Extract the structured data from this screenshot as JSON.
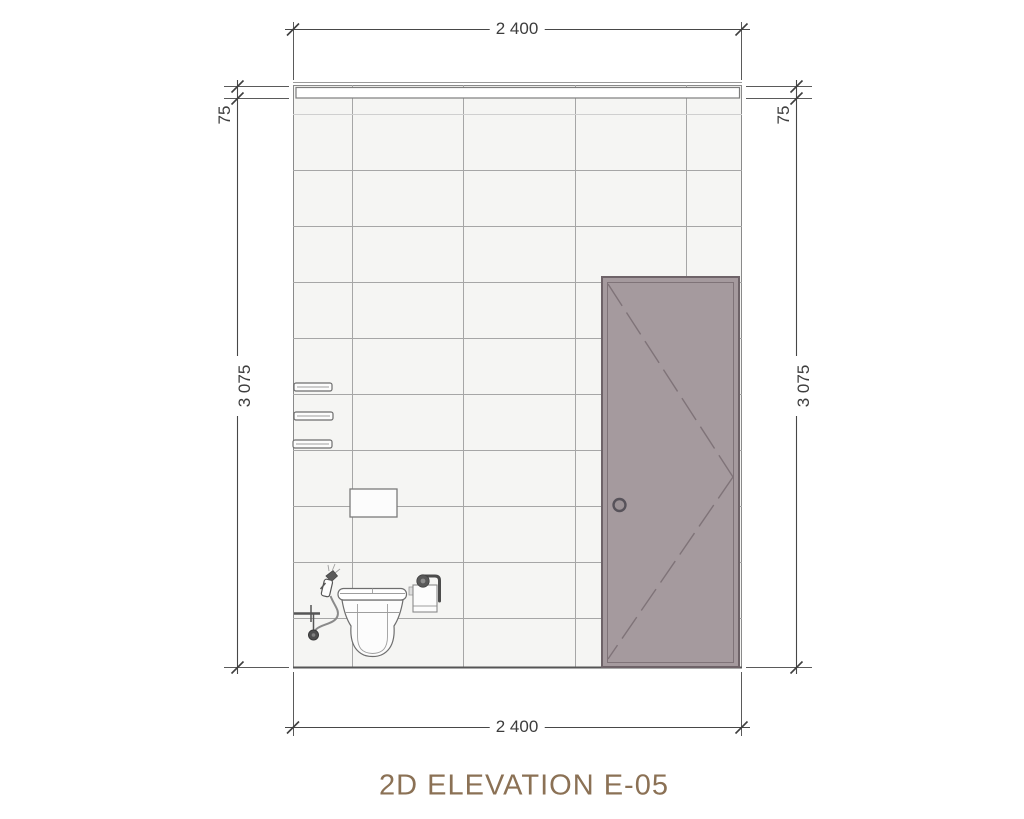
{
  "drawing": {
    "title": "2D ELEVATION E-05",
    "kind": "2D architectural interior elevation of a bathroom wall"
  },
  "dimensions": {
    "top_width": "2 400",
    "bottom_width": "2 400",
    "left_wall_height": "3 075",
    "right_wall_height": "3 075",
    "left_top_band": "75",
    "right_top_band": "75"
  },
  "elements": {
    "wall": "tiled wall with 600x300 tile grid",
    "top_band": "75 mm border band at top of wall",
    "door": "single door leaf with dashed swing indicator and round knob",
    "toilet": "wall-hung toilet, front view",
    "bidet_sprayer": "hand-held bidet sprayer with hose",
    "water_valve": "angle valve with supply pipe",
    "flush_plate": "concealed cistern flush plate",
    "shelves": "three wall shelves, edge view",
    "toilet_paper_holder": "roll holder with hanging paper"
  },
  "colors": {
    "door_fill": "#a59a9e",
    "door_outline": "#6e6368",
    "door_detail": "#7f7378",
    "wall_fill": "#f5f5f3",
    "band_fill": "#ffffff",
    "tile_line": "#a6a6a6",
    "dimension_line": "#474747",
    "dimension_text": "#3d3d3d",
    "title_text": "#8b7155"
  }
}
